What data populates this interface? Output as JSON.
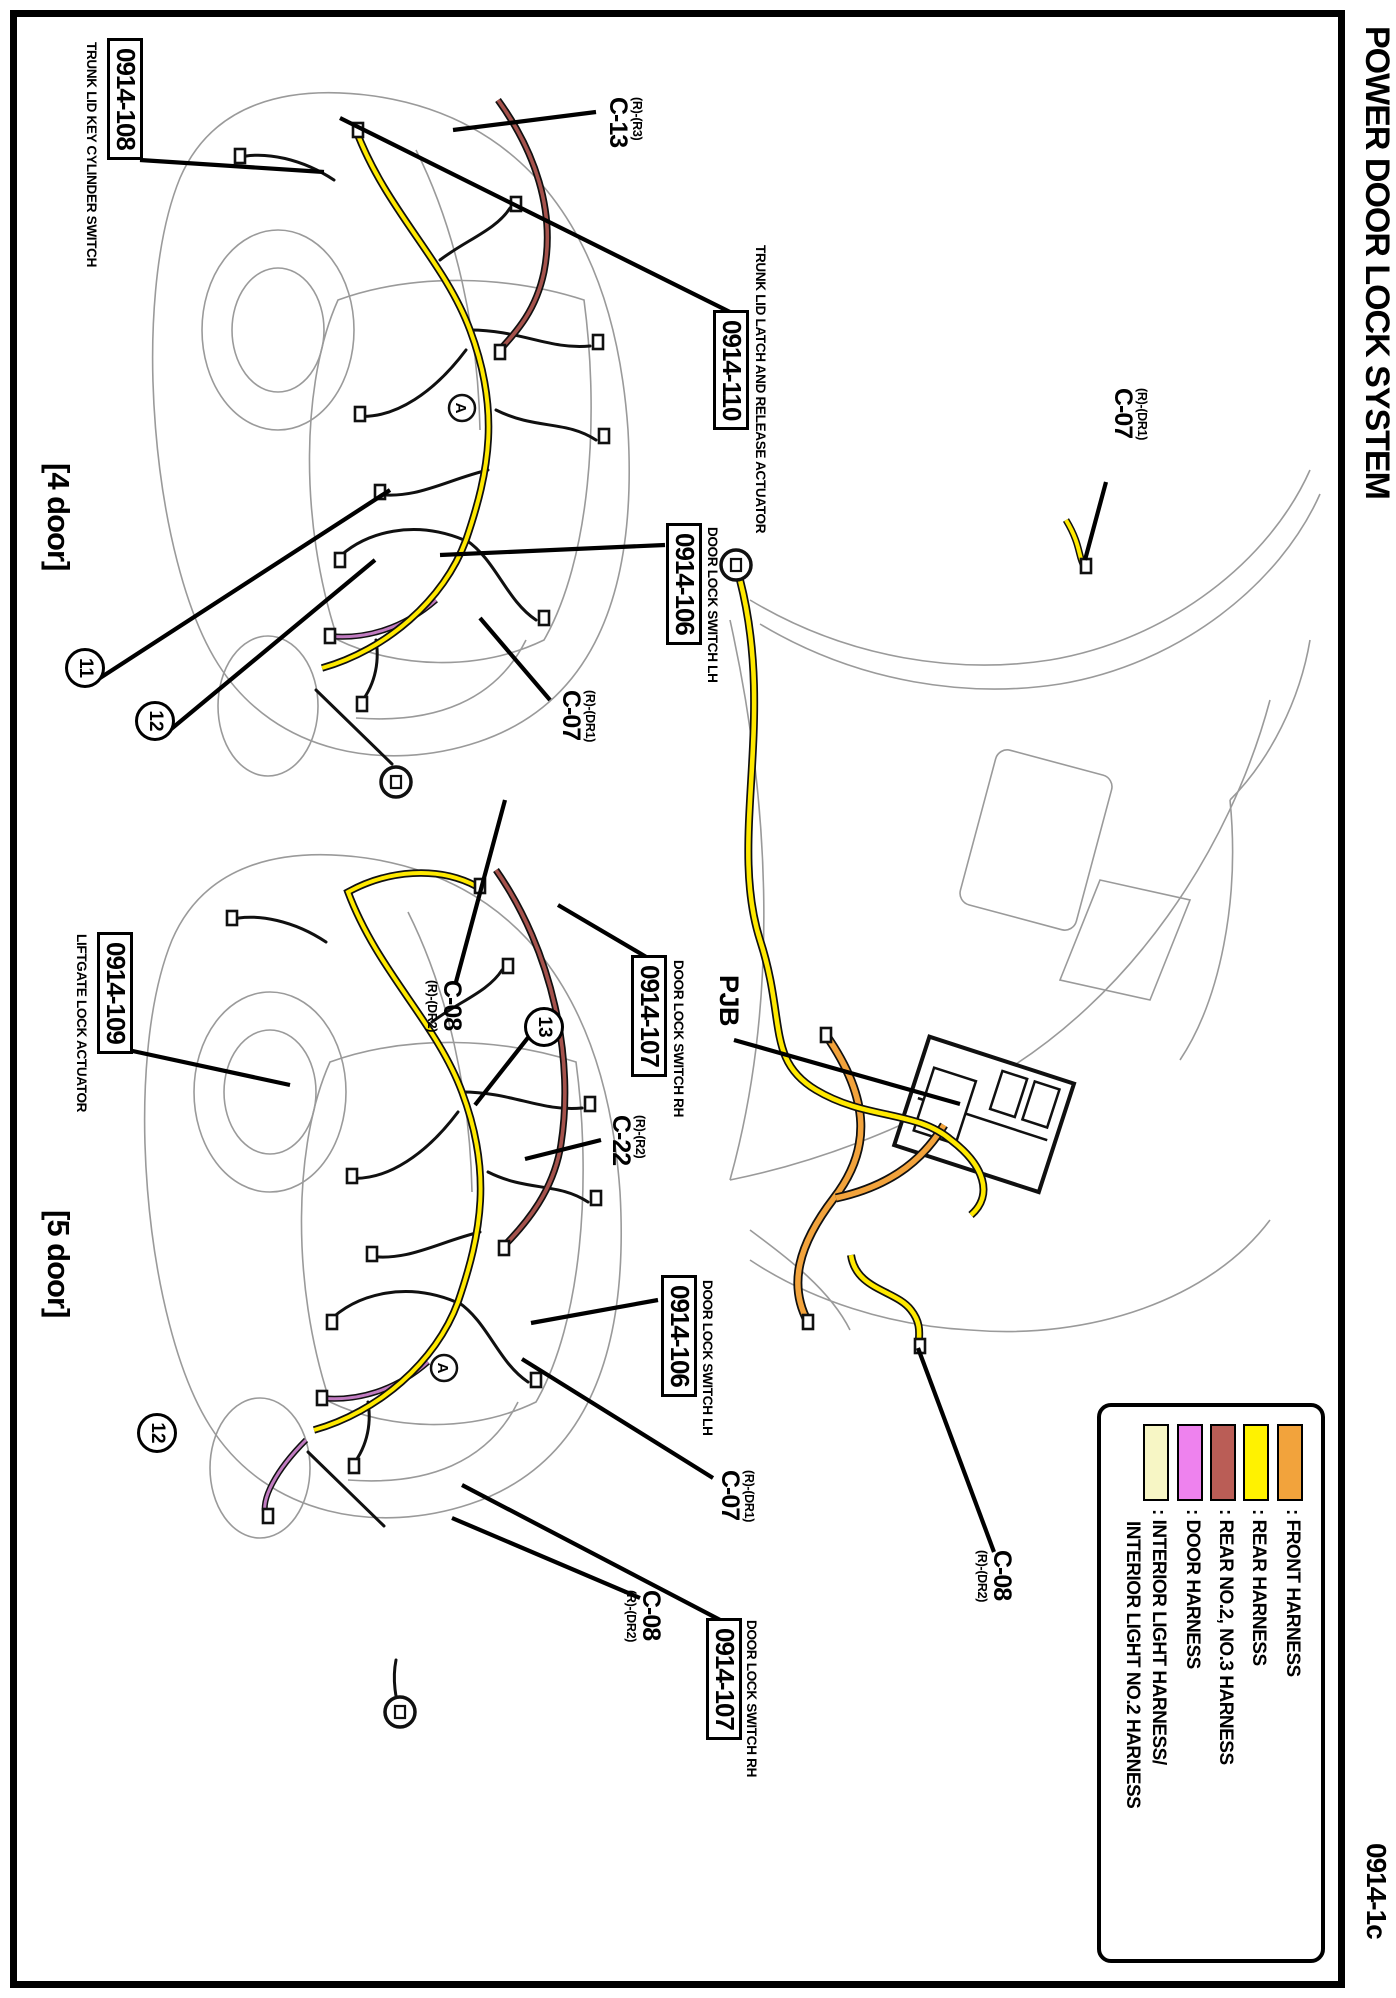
{
  "header": {
    "title": "POWER DOOR LOCK SYSTEM",
    "page_code": "0914-1c"
  },
  "variants": {
    "four_door": "[4 door]",
    "five_door": "[5 door]"
  },
  "four_door": {
    "trunk_key_switch": {
      "code": "0914-108",
      "label": "TRUNK LID KEY CYLINDER SWITCH"
    },
    "c13": {
      "prefix": "(R)-(R3)",
      "code": "C-13"
    },
    "trunk_latch": {
      "code": "0914-110",
      "label": "TRUNK LID LATCH AND RELEASE ACTUATOR"
    },
    "door_lock_lh": {
      "code": "0914-106",
      "label": "DOOR LOCK SWITCH LH"
    },
    "c07": {
      "prefix": "(R)-(DR1)",
      "code": "C-07"
    },
    "c08": {
      "prefix": "(R)-(DR2)",
      "code": "C-08"
    },
    "door_lock_rh": {
      "code": "0914-107",
      "label": "DOOR LOCK SWITCH RH"
    },
    "ref11": "11",
    "ref12": "12"
  },
  "five_door": {
    "liftgate_lock": {
      "code": "0914-109",
      "label": "LIFTGATE LOCK ACTUATOR"
    },
    "ref13": "13",
    "ref12": "12",
    "c22": {
      "prefix": "(R)-(R2)",
      "code": "C-22"
    },
    "door_lock_lh": {
      "code": "0914-106",
      "label": "DOOR LOCK SWITCH LH"
    },
    "c07": {
      "prefix": "(R)-(DR1)",
      "code": "C-07"
    },
    "door_lock_rh": {
      "code": "0914-107",
      "label": "DOOR LOCK SWITCH RH"
    },
    "c08": {
      "prefix": "(R)-(DR2)",
      "code": "C-08"
    }
  },
  "pjb": {
    "label": "PJB",
    "c07": {
      "prefix": "(R)-(DR1)",
      "code": "C-07"
    },
    "c08": {
      "prefix": "(R)-(DR2)",
      "code": "C-08"
    }
  },
  "view_marker": "A",
  "legend": {
    "items": [
      {
        "color": "#F2A33C",
        "label": ": FRONT HARNESS"
      },
      {
        "color": "#FFF200",
        "label": ": REAR HARNESS"
      },
      {
        "color": "#BA5D56",
        "label": ": REAR NO.2, NO.3 HARNESS"
      },
      {
        "color": "#EE82EE",
        "label": ": DOOR HARNESS"
      },
      {
        "color": "#F7F6C5",
        "label": ": INTERIOR LIGHT HARNESS/",
        "label2": "INTERIOR LIGHT NO.2 HARNESS"
      }
    ]
  },
  "colors": {
    "front": "#F2A33C",
    "rear": "#FFE900",
    "rear23": "#A5524C",
    "door": "#C17BC1",
    "outline": "#9a9a9a",
    "wire": "#101010"
  }
}
